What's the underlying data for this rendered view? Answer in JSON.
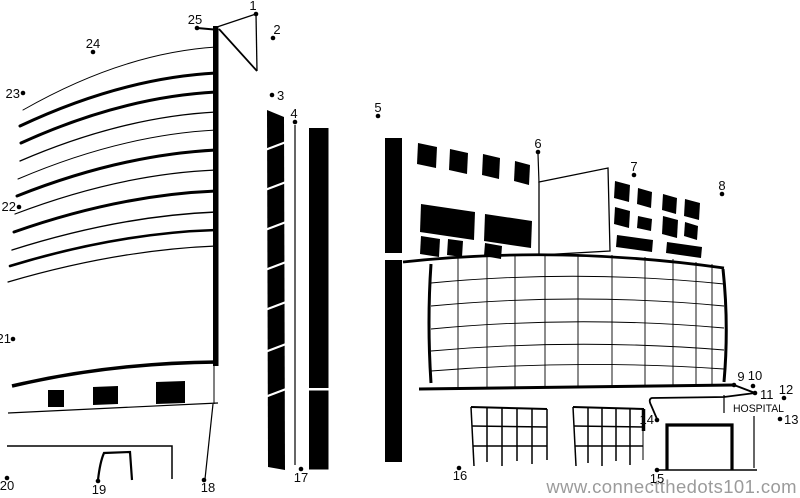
{
  "page": {
    "background": "#ffffff",
    "ink": "#000000",
    "dot_count": 25
  },
  "building": {
    "sign_text": "HOSPITAL"
  },
  "watermark": {
    "text": "www.connectthedots101.com",
    "color": "#9b9b9b",
    "highlight": "#ffffff"
  },
  "dots": [
    {
      "n": "1",
      "x": 256,
      "y": 14,
      "lx": 253,
      "ly": 10,
      "anchor": "middle"
    },
    {
      "n": "2",
      "x": 273,
      "y": 38,
      "lx": 277,
      "ly": 34,
      "anchor": "middle"
    },
    {
      "n": "3",
      "x": 272,
      "y": 95,
      "lx": 277,
      "ly": 100,
      "anchor": "start"
    },
    {
      "n": "4",
      "x": 295,
      "y": 122,
      "lx": 294,
      "ly": 118,
      "anchor": "middle"
    },
    {
      "n": "5",
      "x": 378,
      "y": 116,
      "lx": 378,
      "ly": 112,
      "anchor": "middle"
    },
    {
      "n": "6",
      "x": 538,
      "y": 152,
      "lx": 538,
      "ly": 148,
      "anchor": "middle"
    },
    {
      "n": "7",
      "x": 634,
      "y": 175,
      "lx": 634,
      "ly": 171,
      "anchor": "middle"
    },
    {
      "n": "8",
      "x": 722,
      "y": 194,
      "lx": 722,
      "ly": 190,
      "anchor": "middle"
    },
    {
      "n": "9",
      "x": 734,
      "y": 385,
      "lx": 741,
      "ly": 381,
      "anchor": "middle"
    },
    {
      "n": "10",
      "x": 753,
      "y": 386,
      "lx": 755,
      "ly": 380,
      "anchor": "middle"
    },
    {
      "n": "11",
      "x": 755,
      "y": 393,
      "lx": 760,
      "ly": 399,
      "anchor": "start"
    },
    {
      "n": "12",
      "x": 784,
      "y": 398,
      "lx": 786,
      "ly": 394,
      "anchor": "middle"
    },
    {
      "n": "13",
      "x": 780,
      "y": 419,
      "lx": 784,
      "ly": 424,
      "anchor": "start"
    },
    {
      "n": "14",
      "x": 657,
      "y": 420,
      "lx": 654,
      "ly": 424,
      "anchor": "end"
    },
    {
      "n": "15",
      "x": 657,
      "y": 470,
      "lx": 657,
      "ly": 483,
      "anchor": "middle"
    },
    {
      "n": "16",
      "x": 459,
      "y": 468,
      "lx": 460,
      "ly": 480,
      "anchor": "middle"
    },
    {
      "n": "17",
      "x": 301,
      "y": 469,
      "lx": 301,
      "ly": 482,
      "anchor": "middle"
    },
    {
      "n": "18",
      "x": 204,
      "y": 480,
      "lx": 208,
      "ly": 492,
      "anchor": "middle"
    },
    {
      "n": "19",
      "x": 98,
      "y": 481,
      "lx": 99,
      "ly": 494,
      "anchor": "middle"
    },
    {
      "n": "20",
      "x": 7,
      "y": 478,
      "lx": 7,
      "ly": 490,
      "anchor": "middle"
    },
    {
      "n": "21",
      "x": 13,
      "y": 339,
      "lx": 11,
      "ly": 343,
      "anchor": "end"
    },
    {
      "n": "22",
      "x": 19,
      "y": 207,
      "lx": 16,
      "ly": 211,
      "anchor": "end"
    },
    {
      "n": "23",
      "x": 23,
      "y": 93,
      "lx": 20,
      "ly": 98,
      "anchor": "end"
    },
    {
      "n": "24",
      "x": 93,
      "y": 52,
      "lx": 93,
      "ly": 48,
      "anchor": "middle"
    },
    {
      "n": "25",
      "x": 197,
      "y": 28,
      "lx": 195,
      "ly": 24,
      "anchor": "middle"
    }
  ]
}
